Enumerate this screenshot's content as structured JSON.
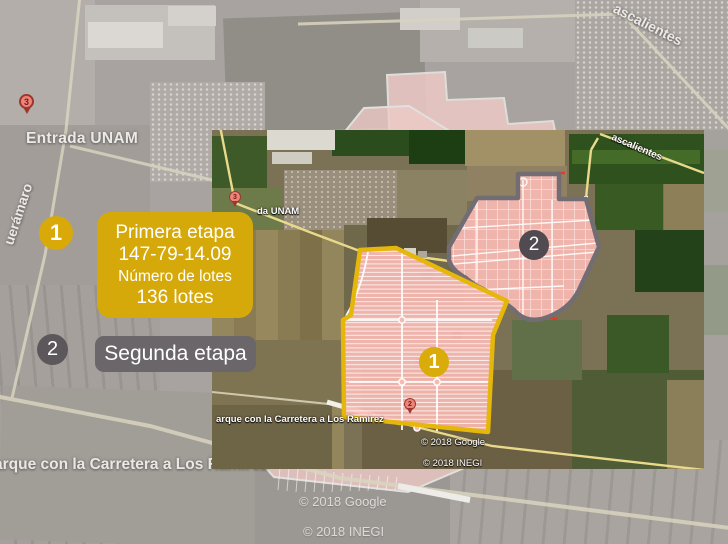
{
  "legend": {
    "item1": {
      "number": "1",
      "title": "Primera etapa",
      "measure": "147-79-14.09",
      "lots_label": "Número de lotes",
      "lots_value": "136 lotes",
      "color": "#d6a90a"
    },
    "item2": {
      "number": "2",
      "title": "Segunda etapa",
      "color": "#6a666a"
    }
  },
  "background_map": {
    "pin3": "3",
    "place_label": "Entrada UNAM",
    "road_left": "uerámaro",
    "road_upper_right": "ascalientes",
    "road_bottom": "arque con la Carretera a Los Ramírez",
    "copyright_google": "© 2018 Google",
    "copyright_inegi": "© 2018 INEGI"
  },
  "inset_map": {
    "pin3": "3",
    "pin2": "2",
    "place_label": "da UNAM",
    "road_upper_right": "ascalientes",
    "road_bottom": "arque con la Carretera a Los Ramírez",
    "copyright_google": "© 2018 Google",
    "copyright_inegi": "© 2018 INEGI",
    "parcel1_marker": "1",
    "parcel2_marker": "2"
  },
  "colors": {
    "parcel_fill": "#f7b9b1",
    "parcel1_border": "#e5b70a",
    "parcel2_border": "#716d72",
    "legend_yellow": "#d6a90a",
    "legend_gray": "#6a666a"
  }
}
